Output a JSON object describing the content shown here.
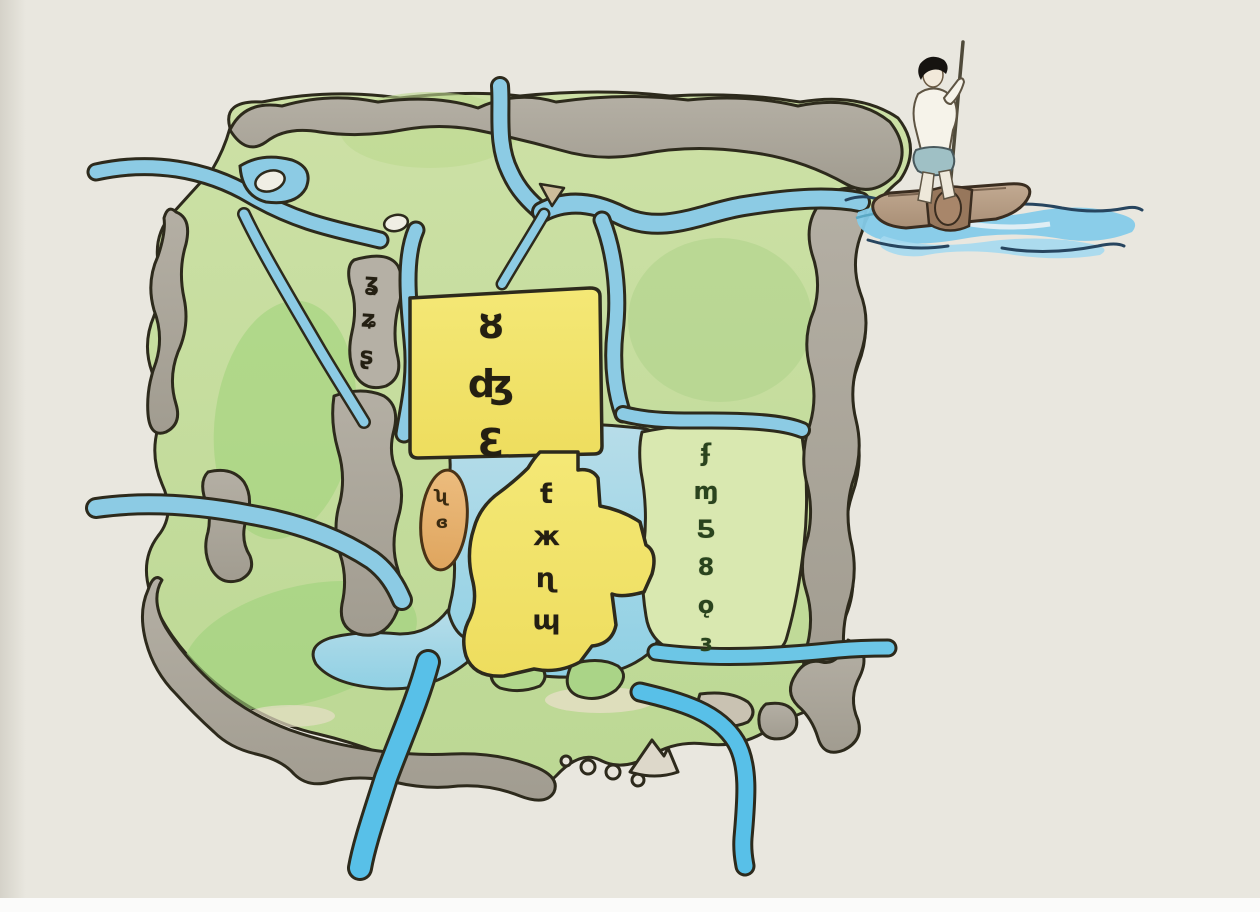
{
  "scene": {
    "title": "Hand-drawn watercolor map of a canal town",
    "subject": "Stylized ink-and-watercolor map with rivers, green parcels, gray roads, yellow districts and a boatman poling a wooden raft at the upper right",
    "medium": "watercolor sketch"
  },
  "map": {
    "labels": {
      "street_strip": "ʓʑʂ",
      "central_district": "ȣʤƐ",
      "lake_island": "ʯɞ",
      "south_district": "ƭжɳɰ",
      "east_district": "ʄɱƼ8ǫɜ",
      "glyph_style": "illegible hand-brushed characters (approximated glyphs)"
    },
    "features": [
      "canal network with three edge outlets",
      "central lake",
      "yellow walled district with brush label",
      "orange oval island",
      "gray ring roads",
      "stone dots and hill marker at south",
      "boatman on raft vignette"
    ]
  },
  "boatman": {
    "description": "figure with black hair, white shirt and blue-gray shorts poling a brown raft on blue waves"
  },
  "palette": {
    "paper": "#e9e7df",
    "canal_blue": "#8ccbe4",
    "bright_river_blue": "#58c0e8",
    "lake_blue": "#a9d8e6",
    "land_green": "#c3dc9c",
    "bright_green": "#9ed27c",
    "east_parcel_green": "#d9e8b0",
    "road_gray": "#aba69b",
    "district_yellow": "#f2e368",
    "island_orange": "#e5ad6c",
    "raft_brown": "#b39a82",
    "wave_navy": "#27455f",
    "outline_ink": "#2d2a1c"
  }
}
